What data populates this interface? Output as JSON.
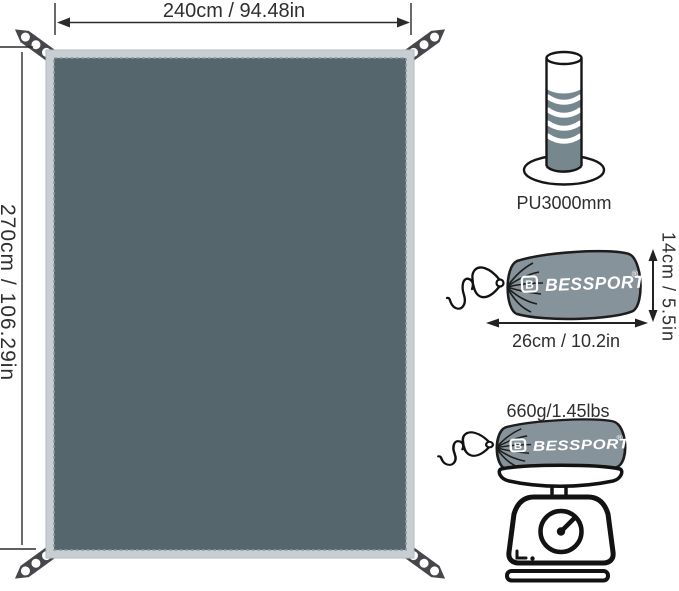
{
  "brand": {
    "name": "BESSPORT",
    "registered": "®",
    "icon_letter": "B"
  },
  "tarp": {
    "width_label": "240cm / 94.48in",
    "height_label": "270cm / 106.29in"
  },
  "waterproof": {
    "label": "PU3000mm"
  },
  "packed_size": {
    "width_label": "26cm / 10.2in",
    "height_label": "14cm / 5.5in"
  },
  "weight": {
    "label": "660g/1.45lbs"
  },
  "colors": {
    "fabric": "#56666d",
    "binding": "#c9ced3",
    "stitch": "#8d979e",
    "strap": "#47474b",
    "sack": "#87939a",
    "water": "#77878e",
    "outline": "#161616",
    "text": "#2f2f2f"
  }
}
